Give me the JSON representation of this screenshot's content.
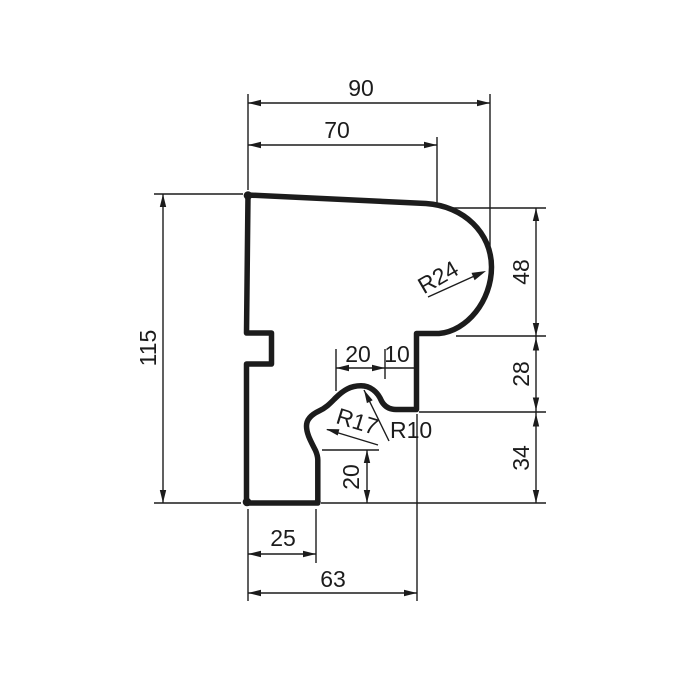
{
  "drawing": {
    "kind": "technical-profile-cross-section",
    "background": "#ffffff",
    "ink": "#1c1c1c"
  },
  "dimensions": {
    "top": {
      "outer": "90",
      "inner": "70"
    },
    "left": {
      "height": "115"
    },
    "right": {
      "upper": "48",
      "middle": "28",
      "lower": "34"
    },
    "middle": {
      "bump_width": "20",
      "step_width": "10",
      "foot_height": "20"
    },
    "bottom": {
      "inner": "25",
      "outer": "63"
    }
  },
  "radii": {
    "bulge": "R24",
    "cove": "R17",
    "fillet": "R10"
  }
}
